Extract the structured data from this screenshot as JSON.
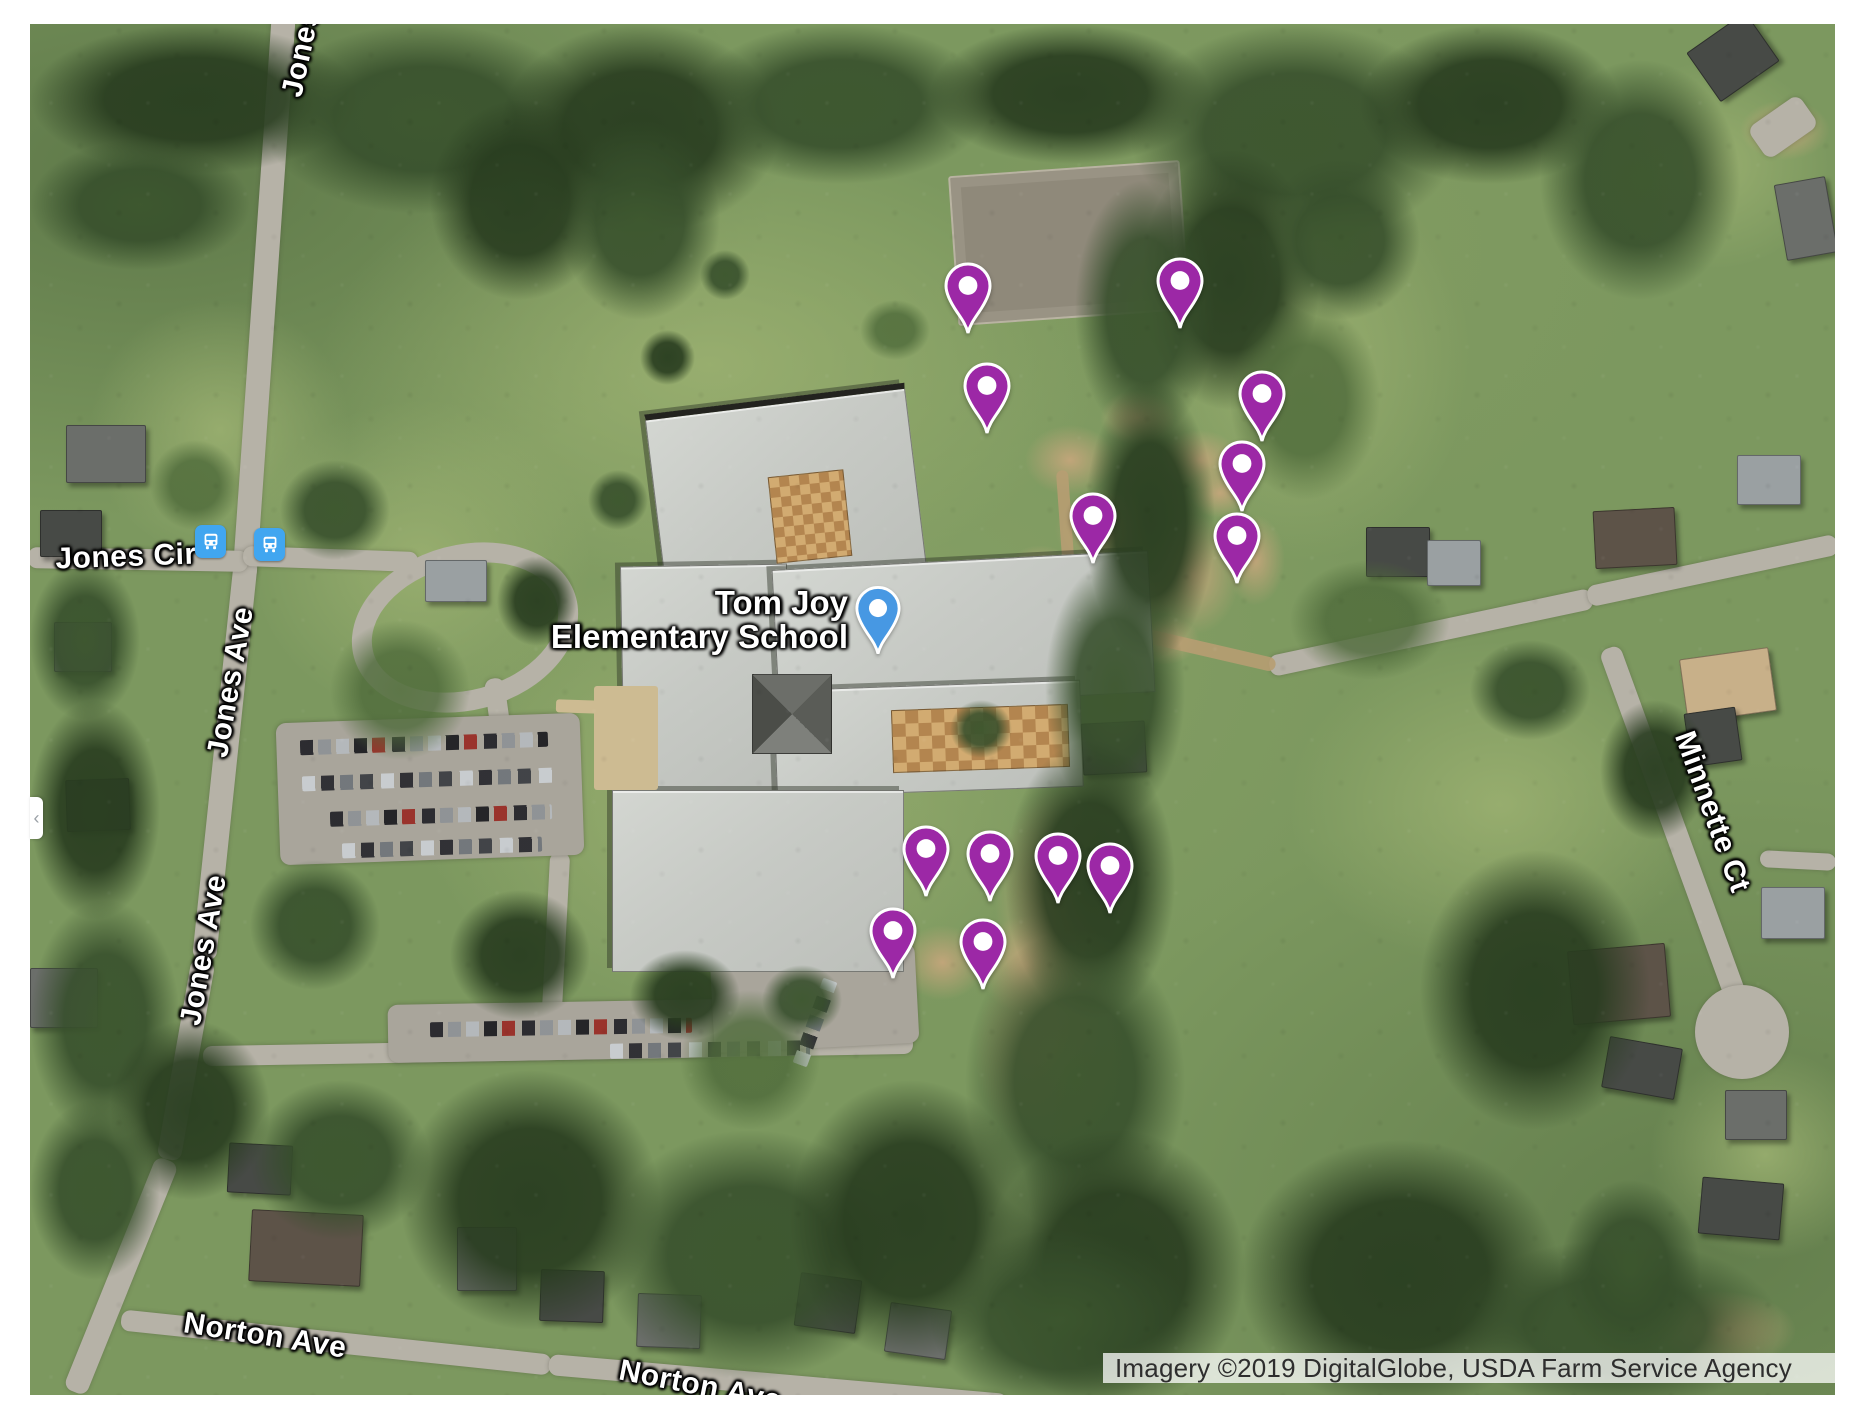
{
  "app": {
    "name": "Google Maps satellite view"
  },
  "map": {
    "poi_label": {
      "line1": "Tom Joy",
      "line2": "Elementary School"
    },
    "road_labels": [
      {
        "id": "jones-ave-top",
        "text": "Jones Ave",
        "x": 308,
        "y": 22,
        "rot": -78
      },
      {
        "id": "jones-cir",
        "text": "Jones Cir",
        "x": 126,
        "y": 557,
        "rot": -2
      },
      {
        "id": "jones-ave-mid",
        "text": "Jones Ave",
        "x": 231,
        "y": 682,
        "rot": -80
      },
      {
        "id": "jones-ave-low",
        "text": "Jones Ave",
        "x": 204,
        "y": 950,
        "rot": -80
      },
      {
        "id": "norton-ave-1",
        "text": "Norton Ave",
        "x": 265,
        "y": 1336,
        "rot": 9
      },
      {
        "id": "norton-ave-2",
        "text": "Norton Ave",
        "x": 700,
        "y": 1386,
        "rot": 11
      },
      {
        "id": "minnette-ct",
        "text": "Minnette Ct",
        "x": 1712,
        "y": 812,
        "rot": 70
      }
    ],
    "markers": {
      "purple_pins": [
        {
          "x": 968,
          "y": 337
        },
        {
          "x": 1180,
          "y": 332
        },
        {
          "x": 987,
          "y": 437
        },
        {
          "x": 1262,
          "y": 445
        },
        {
          "x": 1242,
          "y": 515
        },
        {
          "x": 1093,
          "y": 567
        },
        {
          "x": 1237,
          "y": 587
        },
        {
          "x": 926,
          "y": 900
        },
        {
          "x": 990,
          "y": 905
        },
        {
          "x": 1058,
          "y": 907
        },
        {
          "x": 1110,
          "y": 917
        },
        {
          "x": 893,
          "y": 982
        },
        {
          "x": 983,
          "y": 993
        }
      ],
      "poi_pin": {
        "x": 878,
        "y": 657
      }
    },
    "transit_stops": [
      {
        "x": 210,
        "y": 541
      },
      {
        "x": 269,
        "y": 544
      }
    ],
    "colors": {
      "pin_purple": "#9C28A6",
      "pin_blue": "#4798E3",
      "transit_blue": "#41A6F0"
    },
    "attribution": "Imagery ©2019 DigitalGlobe, USDA Farm Service Agency"
  }
}
